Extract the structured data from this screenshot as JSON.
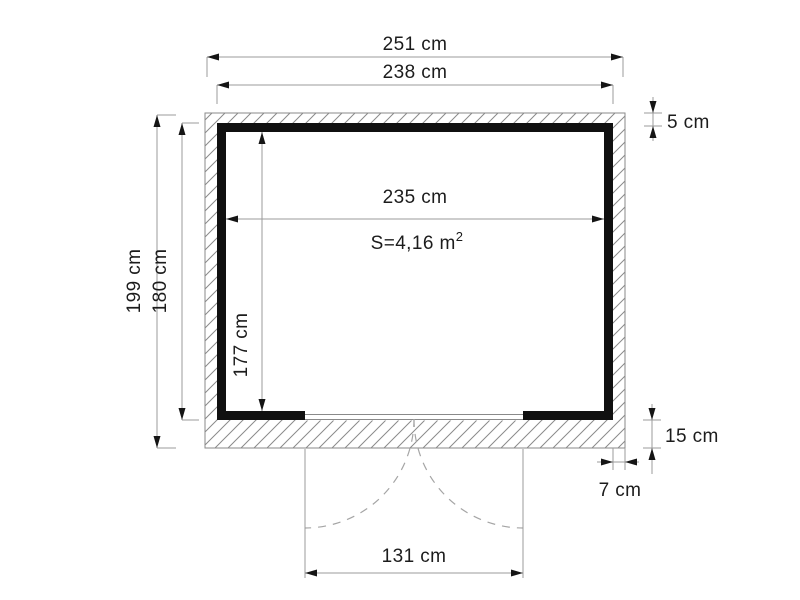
{
  "drawing": {
    "kind": "shed-floor-plan",
    "units": "cm",
    "colors": {
      "wall": "#101010",
      "dim_line": "#9b9b9b",
      "hatch": "#8a8a8a",
      "text": "#1c1c1c",
      "dashed_arc": "#a5a5a5",
      "background": "#ffffff"
    },
    "area": {
      "label": "S=4,16 m",
      "sup": "2",
      "value_m2": 4.16
    },
    "dimensions": [
      {
        "id": "outer-width",
        "label": "251 cm",
        "value_cm": 251,
        "edge": "top, base slab outer width"
      },
      {
        "id": "frame-width",
        "label": "238 cm",
        "value_cm": 238,
        "edge": "top, wall outer width"
      },
      {
        "id": "inner-width",
        "label": "235 cm",
        "value_cm": 235,
        "edge": "interior width"
      },
      {
        "id": "outer-depth",
        "label": "199 cm",
        "value_cm": 199,
        "edge": "left, base slab outer depth"
      },
      {
        "id": "frame-depth",
        "label": "180 cm",
        "value_cm": 180,
        "edge": "left, wall outer depth"
      },
      {
        "id": "inner-depth",
        "label": "177 cm",
        "value_cm": 177,
        "edge": "interior depth"
      },
      {
        "id": "top-overhang",
        "label": "5 cm",
        "value_cm": 5,
        "edge": "top right, slab overhang"
      },
      {
        "id": "bottom-overhang",
        "label": "15 cm",
        "value_cm": 15,
        "edge": "bottom right, slab overhang"
      },
      {
        "id": "side-overhang",
        "label": "7 cm",
        "value_cm": 7,
        "edge": "right, slab overhang"
      },
      {
        "id": "door-width",
        "label": "131 cm",
        "value_cm": 131,
        "edge": "door opening width"
      }
    ]
  }
}
